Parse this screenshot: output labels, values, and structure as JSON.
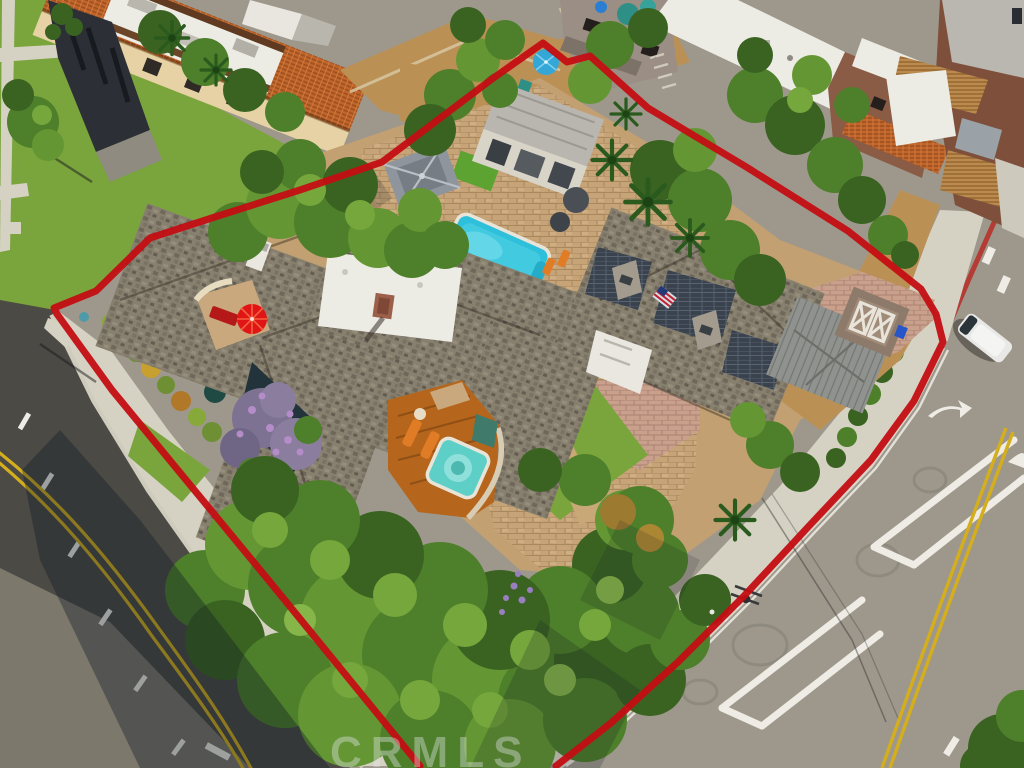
{
  "meta": {
    "type": "aerial-drone-photo",
    "subject": "corner-lot residential estate outlined with red property boundary"
  },
  "watermark": {
    "text": "CRMLS"
  },
  "boundary": {
    "points": "420,766 270,582 112,390 57,314 54,308 96,291 150,238 218,216 300,190 382,162 492,79 543,43 567,62 590,56 648,108 748,168 848,231 921,289 936,314 943,342 914,401 871,460 809,526 744,596 679,661 611,723 556,766"
  },
  "colors": {
    "boundary-red": "#c40e13",
    "asphalt-dark": "#4c4a44",
    "asphalt-light": "#9e988c",
    "sidewalk": "#d6d2c3",
    "lawn": "#7aa43c",
    "dirt": "#bb9055",
    "pavers": "#c7a478",
    "driveway-pink": "#c8a08c",
    "shingle-gray": "#87806f",
    "flat-roof-white": "#ecebe4",
    "terracotta": "#c0662c",
    "pool": "#2ec0da",
    "spa": "#5ecfc6",
    "deck-orange": "#b5661c",
    "lounger-orange": "#e07c26",
    "umbrella-red": "#e01616",
    "umbrella-blue": "#35a7d6",
    "road-yellow": "#d4ae1c",
    "marking-white": "#eeece4",
    "solar-panel": "#39424d"
  },
  "scene": {
    "objects": [
      "red property boundary outline",
      "main residence gray shingle roof with white flat section and brick chimney",
      "guest house with solar panels and american flag",
      "swimming pool with orange loungers",
      "spa hot tub on orange wood deck",
      "gazebo and pool cabana",
      "red patio umbrella courtyard",
      "blue umbrella rear yard",
      "paver motor court and driveway",
      "large south tree canopy and purple flowering tree",
      "left street with double yellow line",
      "right street with chevron markings and turn arrows",
      "white van parked at curb",
      "utility pole with wires",
      "neighboring condo buildings with tile and white flat roofs",
      "CRMLS watermark"
    ]
  }
}
